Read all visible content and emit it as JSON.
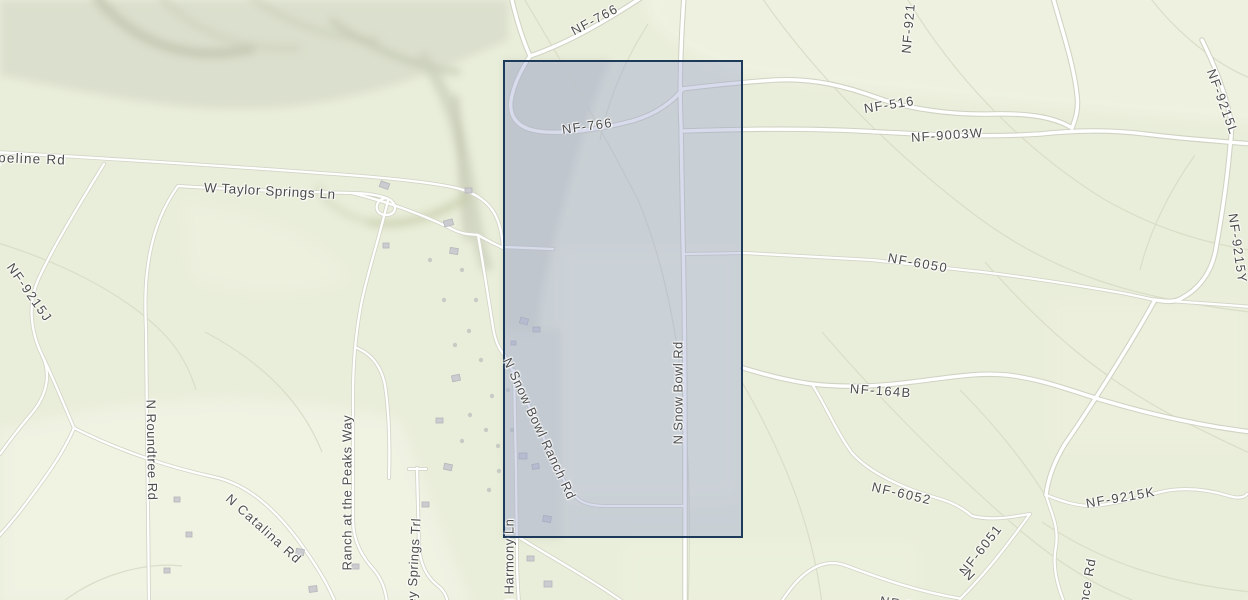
{
  "map": {
    "kind": "topographic-street-map",
    "base_color": "#e9eeda",
    "road_color": "#ffffff",
    "road_casing_color": "#d0d2c3",
    "contour_color": "#d8dcc6",
    "label_color": "#4c4c4c",
    "selection_overlay": {
      "fill": "rgba(150,160,205,0.38)",
      "border_color": "#1e3a5a",
      "border_width_px": 2
    },
    "road_labels": [
      {
        "id": "pipeline-rd",
        "text": "ipeline Rd",
        "x": -6,
        "y": 150,
        "rot": 2,
        "size": 13.5,
        "spacing": 1.2
      },
      {
        "id": "w-taylor-springs-ln",
        "text": "W Taylor Springs Ln",
        "x": 204,
        "y": 180,
        "rot": 3,
        "size": 13.5,
        "spacing": 0.6
      },
      {
        "id": "nf-766-top",
        "text": "NF-766",
        "x": 572,
        "y": 24,
        "rot": -28,
        "spacing": 1.3
      },
      {
        "id": "nf-766",
        "text": "NF-766",
        "x": 562,
        "y": 122,
        "rot": -8,
        "spacing": 1.3
      },
      {
        "id": "nf-516",
        "text": "NF-516",
        "x": 864,
        "y": 101,
        "rot": -9,
        "spacing": 1.3
      },
      {
        "id": "nf-9003w",
        "text": "NF-9003W",
        "x": 911,
        "y": 130,
        "rot": -4,
        "spacing": 1.2
      },
      {
        "id": "nf-921",
        "text": "NF-921",
        "x": 906,
        "y": 46,
        "rot": -85,
        "spacing": 1.2
      },
      {
        "id": "nf-9215l",
        "text": "NF-9215L",
        "x": 1211,
        "y": 62,
        "rot": 70,
        "spacing": 1.4
      },
      {
        "id": "nf-9215y",
        "text": "NF-9215Y",
        "x": 1233,
        "y": 206,
        "rot": 82,
        "spacing": 1.4
      },
      {
        "id": "nf-6050",
        "text": "NF-6050",
        "x": 888,
        "y": 250,
        "rot": 10,
        "spacing": 1.5
      },
      {
        "id": "nf-164b",
        "text": "NF-164B",
        "x": 850,
        "y": 381,
        "rot": 4,
        "spacing": 1.4
      },
      {
        "id": "nf-6052",
        "text": "NF-6052",
        "x": 872,
        "y": 479,
        "rot": 13,
        "spacing": 1.5
      },
      {
        "id": "nf-9215k",
        "text": "NF-9215K",
        "x": 1086,
        "y": 496,
        "rot": -10,
        "spacing": 1.4
      },
      {
        "id": "nf-6051",
        "text": "NF-6051",
        "x": 962,
        "y": 566,
        "rot": -52,
        "spacing": 1.4
      },
      {
        "id": "nf-9214",
        "text": "NF-9214",
        "x": 880,
        "y": 593,
        "rot": 9,
        "spacing": 1.4
      },
      {
        "id": "n-fragment",
        "text": "N",
        "x": 966,
        "y": 564,
        "rot": 45
      },
      {
        "id": "ence-rd",
        "text": "ence Rd",
        "x": 1082,
        "y": 604,
        "rot": -80,
        "spacing": 0.8
      },
      {
        "id": "nf-9215j",
        "text": "NF-9215J",
        "x": 10,
        "y": 257,
        "rot": 55,
        "spacing": 1.4
      },
      {
        "id": "n-roundtree-rd",
        "text": "N Roundtree Rd",
        "x": 151,
        "y": 392,
        "rot": 89,
        "spacing": 0.5
      },
      {
        "id": "ranch-at-the-peaks-way",
        "text": "Ranch at the Peaks Way",
        "x": 347,
        "y": 563,
        "rot": -90,
        "spacing": 0.6
      },
      {
        "id": "n-catalina-rd",
        "text": "N Catalina Rd",
        "x": 228,
        "y": 489,
        "rot": 42,
        "spacing": 1.2
      },
      {
        "id": "ney-springs-trl",
        "text": "ney Springs Trl",
        "x": 411,
        "y": 606,
        "rot": -87,
        "spacing": 0.6
      },
      {
        "id": "n-snow-bowl-ranch-rd",
        "text": "N Snow Bowl Ranch Rd",
        "x": 507,
        "y": 351,
        "rot": 65,
        "spacing": 0.8
      },
      {
        "id": "n-snow-bowl-rd",
        "text": "N Snow Bowl Rd",
        "x": 678,
        "y": 437,
        "rot": -90,
        "spacing": 0.4
      },
      {
        "id": "n-harmony-ln",
        "text": "N Harmony Ln",
        "x": 509,
        "y": 601,
        "rot": -90,
        "spacing": 0.5
      }
    ]
  }
}
